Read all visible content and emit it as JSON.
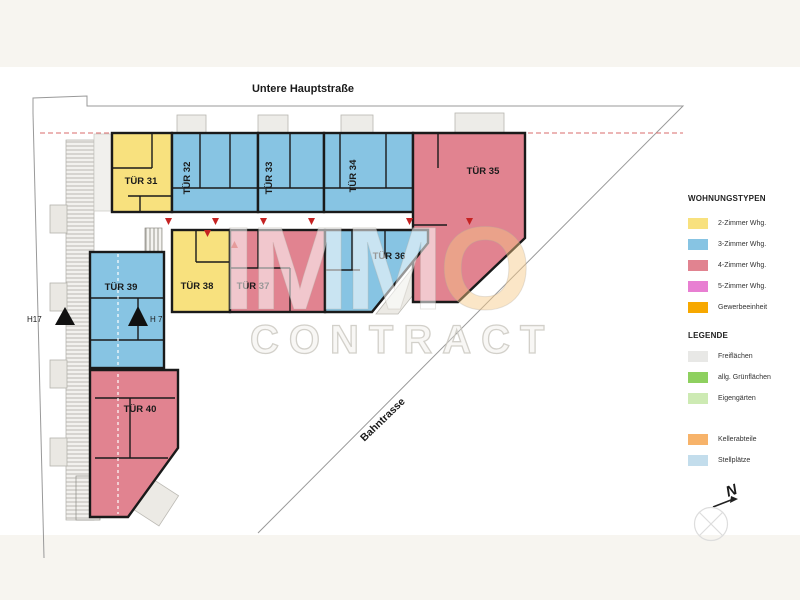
{
  "street_label": "Untere Hauptstraße",
  "rail_label": "Bahntrasse",
  "markers": {
    "h17": "H17",
    "h7": "H 7",
    "north": "N"
  },
  "watermark": {
    "brand_a": "IMM",
    "brand_b": "O",
    "brand_line2": "CONTRACT"
  },
  "units": [
    {
      "id": "tuer-31",
      "label": "TÜR 31",
      "type": "2-Zimmer Whg."
    },
    {
      "id": "tuer-32",
      "label": "TÜR 32",
      "type": "3-Zimmer Whg."
    },
    {
      "id": "tuer-33",
      "label": "TÜR 33",
      "type": "3-Zimmer Whg."
    },
    {
      "id": "tuer-34",
      "label": "TÜR 34",
      "type": "3-Zimmer Whg."
    },
    {
      "id": "tuer-35",
      "label": "TÜR 35",
      "type": "4-Zimmer Whg."
    },
    {
      "id": "tuer-36",
      "label": "TÜR 36",
      "type": "3-Zimmer Whg."
    },
    {
      "id": "tuer-37",
      "label": "TÜR 37",
      "type": "4-Zimmer Whg."
    },
    {
      "id": "tuer-38",
      "label": "TÜR 38",
      "type": "2-Zimmer Whg."
    },
    {
      "id": "tuer-39",
      "label": "TÜR 39",
      "type": "3-Zimmer Whg."
    },
    {
      "id": "tuer-40",
      "label": "TÜR 40",
      "type": "4-Zimmer Whg."
    }
  ],
  "colors": {
    "wall": "#1a1a1a",
    "dashed_boundary": "#d96b6b",
    "door_marker": "#c52222",
    "site_line": "#999999",
    "background_margin": "#f7f5f0"
  },
  "legend_types": {
    "title": "WOHNUNGSTYPEN",
    "items": [
      {
        "label": "2-Zimmer Whg.",
        "color": "#f8e17e"
      },
      {
        "label": "3-Zimmer Whg.",
        "color": "#87c4e3"
      },
      {
        "label": "4-Zimmer Whg.",
        "color": "#e18390"
      },
      {
        "label": "5-Zimmer Whg.",
        "color": "#e87fd2"
      },
      {
        "label": "Gewerbeeinheit",
        "color": "#f7a800"
      }
    ]
  },
  "legend_general": {
    "title": "LEGENDE",
    "items": [
      {
        "label": "Freiflächen",
        "color": "#e8e8e6"
      },
      {
        "label": "allg. Grünflächen",
        "color": "#8ed05f"
      },
      {
        "label": "Eigengärten",
        "color": "#cdeab3"
      },
      {
        "label": "Kellerabteile",
        "color": "#f7b36a"
      },
      {
        "label": "Stellplätze",
        "color": "#c3ddec"
      }
    ]
  }
}
